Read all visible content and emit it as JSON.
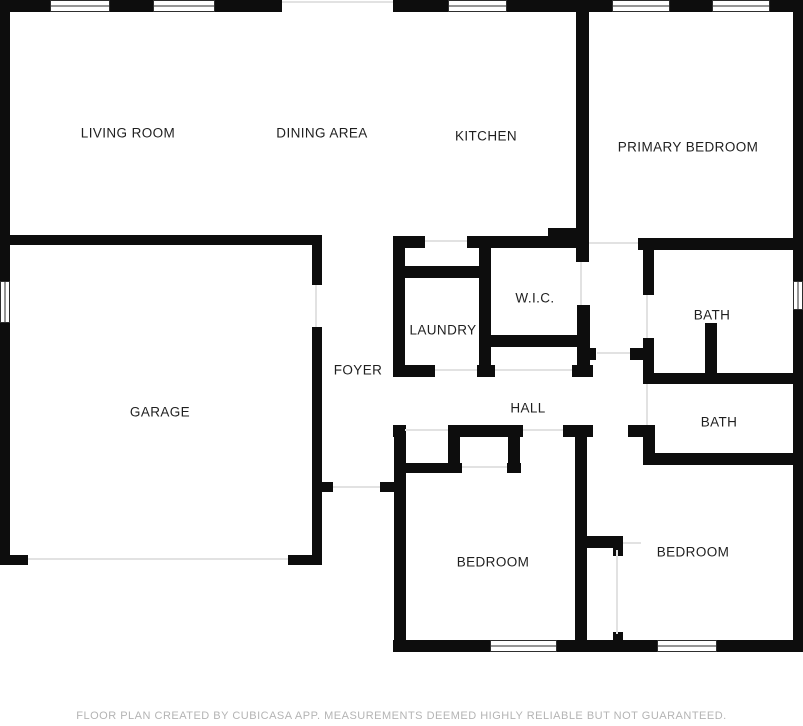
{
  "floorplan": {
    "canvas": {
      "width": 803,
      "height": 726
    },
    "colors": {
      "wall": "#0d0d0d",
      "label": "#1f1f1f",
      "opening": "#e2e2e2",
      "window_frame": "#2e2e2e"
    },
    "rooms": [
      {
        "id": "living-room",
        "label": "LIVING ROOM",
        "x": 128,
        "y": 133
      },
      {
        "id": "dining-area",
        "label": "DINING AREA",
        "x": 322,
        "y": 133
      },
      {
        "id": "kitchen",
        "label": "KITCHEN",
        "x": 486,
        "y": 136
      },
      {
        "id": "primary-bedroom",
        "label": "PRIMARY BEDROOM",
        "x": 688,
        "y": 147
      },
      {
        "id": "garage",
        "label": "GARAGE",
        "x": 160,
        "y": 412
      },
      {
        "id": "foyer",
        "label": "FOYER",
        "x": 358,
        "y": 370
      },
      {
        "id": "laundry",
        "label": "LAUNDRY",
        "x": 443,
        "y": 330
      },
      {
        "id": "wic",
        "label": "W.I.C.",
        "x": 535,
        "y": 298
      },
      {
        "id": "hall",
        "label": "HALL",
        "x": 528,
        "y": 408
      },
      {
        "id": "bath-upper",
        "label": "BATH",
        "x": 712,
        "y": 315
      },
      {
        "id": "bath-lower",
        "label": "BATH",
        "x": 719,
        "y": 422
      },
      {
        "id": "bedroom-left",
        "label": "BEDROOM",
        "x": 493,
        "y": 562
      },
      {
        "id": "bedroom-right",
        "label": "BEDROOM",
        "x": 693,
        "y": 552
      }
    ],
    "walls": [
      [
        0,
        0,
        50,
        12
      ],
      [
        110,
        0,
        43,
        12
      ],
      [
        215,
        0,
        67,
        12
      ],
      [
        393,
        0,
        55,
        12
      ],
      [
        507,
        0,
        105,
        12
      ],
      [
        670,
        0,
        42,
        12
      ],
      [
        770,
        0,
        33,
        12
      ],
      [
        0,
        0,
        10,
        281
      ],
      [
        0,
        323,
        10,
        242
      ],
      [
        793,
        0,
        10,
        281
      ],
      [
        793,
        310,
        10,
        341
      ],
      [
        393,
        640,
        97,
        12
      ],
      [
        557,
        640,
        100,
        12
      ],
      [
        717,
        640,
        86,
        12
      ],
      [
        0,
        235,
        322,
        10
      ],
      [
        312,
        245,
        10,
        40
      ],
      [
        312,
        327,
        10,
        238
      ],
      [
        0,
        555,
        28,
        10
      ],
      [
        288,
        555,
        34,
        10
      ],
      [
        322,
        482,
        11,
        10
      ],
      [
        380,
        482,
        14,
        10
      ],
      [
        576,
        12,
        13,
        250
      ],
      [
        577,
        305,
        13,
        72
      ],
      [
        583,
        348,
        13,
        12
      ],
      [
        638,
        238,
        165,
        12
      ],
      [
        393,
        236,
        32,
        12
      ],
      [
        467,
        236,
        109,
        12
      ],
      [
        548,
        228,
        28,
        10
      ],
      [
        393,
        266,
        95,
        12
      ],
      [
        393,
        236,
        12,
        141
      ],
      [
        479,
        245,
        12,
        120
      ],
      [
        483,
        335,
        100,
        12
      ],
      [
        393,
        365,
        42,
        12
      ],
      [
        477,
        365,
        18,
        12
      ],
      [
        572,
        365,
        21,
        12
      ],
      [
        393,
        425,
        13,
        12
      ],
      [
        448,
        425,
        75,
        12
      ],
      [
        563,
        425,
        30,
        12
      ],
      [
        628,
        425,
        27,
        12
      ],
      [
        394,
        425,
        12,
        227
      ],
      [
        448,
        425,
        12,
        48
      ],
      [
        398,
        463,
        64,
        10
      ],
      [
        508,
        427,
        12,
        46
      ],
      [
        507,
        463,
        14,
        10
      ],
      [
        575,
        425,
        12,
        227
      ],
      [
        580,
        536,
        43,
        12
      ],
      [
        613,
        548,
        10,
        8
      ],
      [
        613,
        632,
        10,
        10
      ],
      [
        643,
        250,
        11,
        45
      ],
      [
        643,
        338,
        11,
        35
      ],
      [
        630,
        348,
        14,
        12
      ],
      [
        643,
        373,
        160,
        11
      ],
      [
        705,
        323,
        12,
        50
      ],
      [
        643,
        425,
        12,
        33
      ],
      [
        643,
        453,
        160,
        12
      ]
    ],
    "openings": [
      [
        282,
        1,
        111,
        2
      ],
      [
        28,
        558,
        260,
        2
      ],
      [
        315,
        285,
        2,
        42
      ],
      [
        333,
        486,
        47,
        2
      ],
      [
        405,
        429,
        43,
        2
      ],
      [
        523,
        429,
        40,
        2
      ],
      [
        462,
        466,
        45,
        2
      ],
      [
        435,
        369,
        42,
        2
      ],
      [
        495,
        369,
        77,
        2
      ],
      [
        589,
        242,
        49,
        2
      ],
      [
        580,
        262,
        2,
        43
      ],
      [
        646,
        295,
        2,
        43
      ],
      [
        646,
        384,
        2,
        41
      ],
      [
        597,
        352,
        33,
        2
      ],
      [
        623,
        542,
        18,
        2
      ],
      [
        616,
        550,
        2,
        84
      ],
      [
        425,
        240,
        42,
        2
      ]
    ],
    "windows": [
      {
        "x": 50,
        "y": 0,
        "w": 60,
        "h": 12,
        "o": "h"
      },
      {
        "x": 153,
        "y": 0,
        "w": 62,
        "h": 12,
        "o": "h"
      },
      {
        "x": 448,
        "y": 0,
        "w": 59,
        "h": 12,
        "o": "h"
      },
      {
        "x": 612,
        "y": 0,
        "w": 58,
        "h": 12,
        "o": "h"
      },
      {
        "x": 712,
        "y": 0,
        "w": 58,
        "h": 12,
        "o": "h"
      },
      {
        "x": 490,
        "y": 640,
        "w": 67,
        "h": 12,
        "o": "h"
      },
      {
        "x": 657,
        "y": 640,
        "w": 60,
        "h": 12,
        "o": "h"
      },
      {
        "x": 0,
        "y": 281,
        "w": 10,
        "h": 42,
        "o": "v"
      },
      {
        "x": 793,
        "y": 281,
        "w": 10,
        "h": 29,
        "o": "v"
      }
    ]
  },
  "footer": {
    "text": "FLOOR PLAN CREATED BY CUBICASA APP. MEASUREMENTS DEEMED HIGHLY RELIABLE BUT NOT GUARANTEED."
  }
}
